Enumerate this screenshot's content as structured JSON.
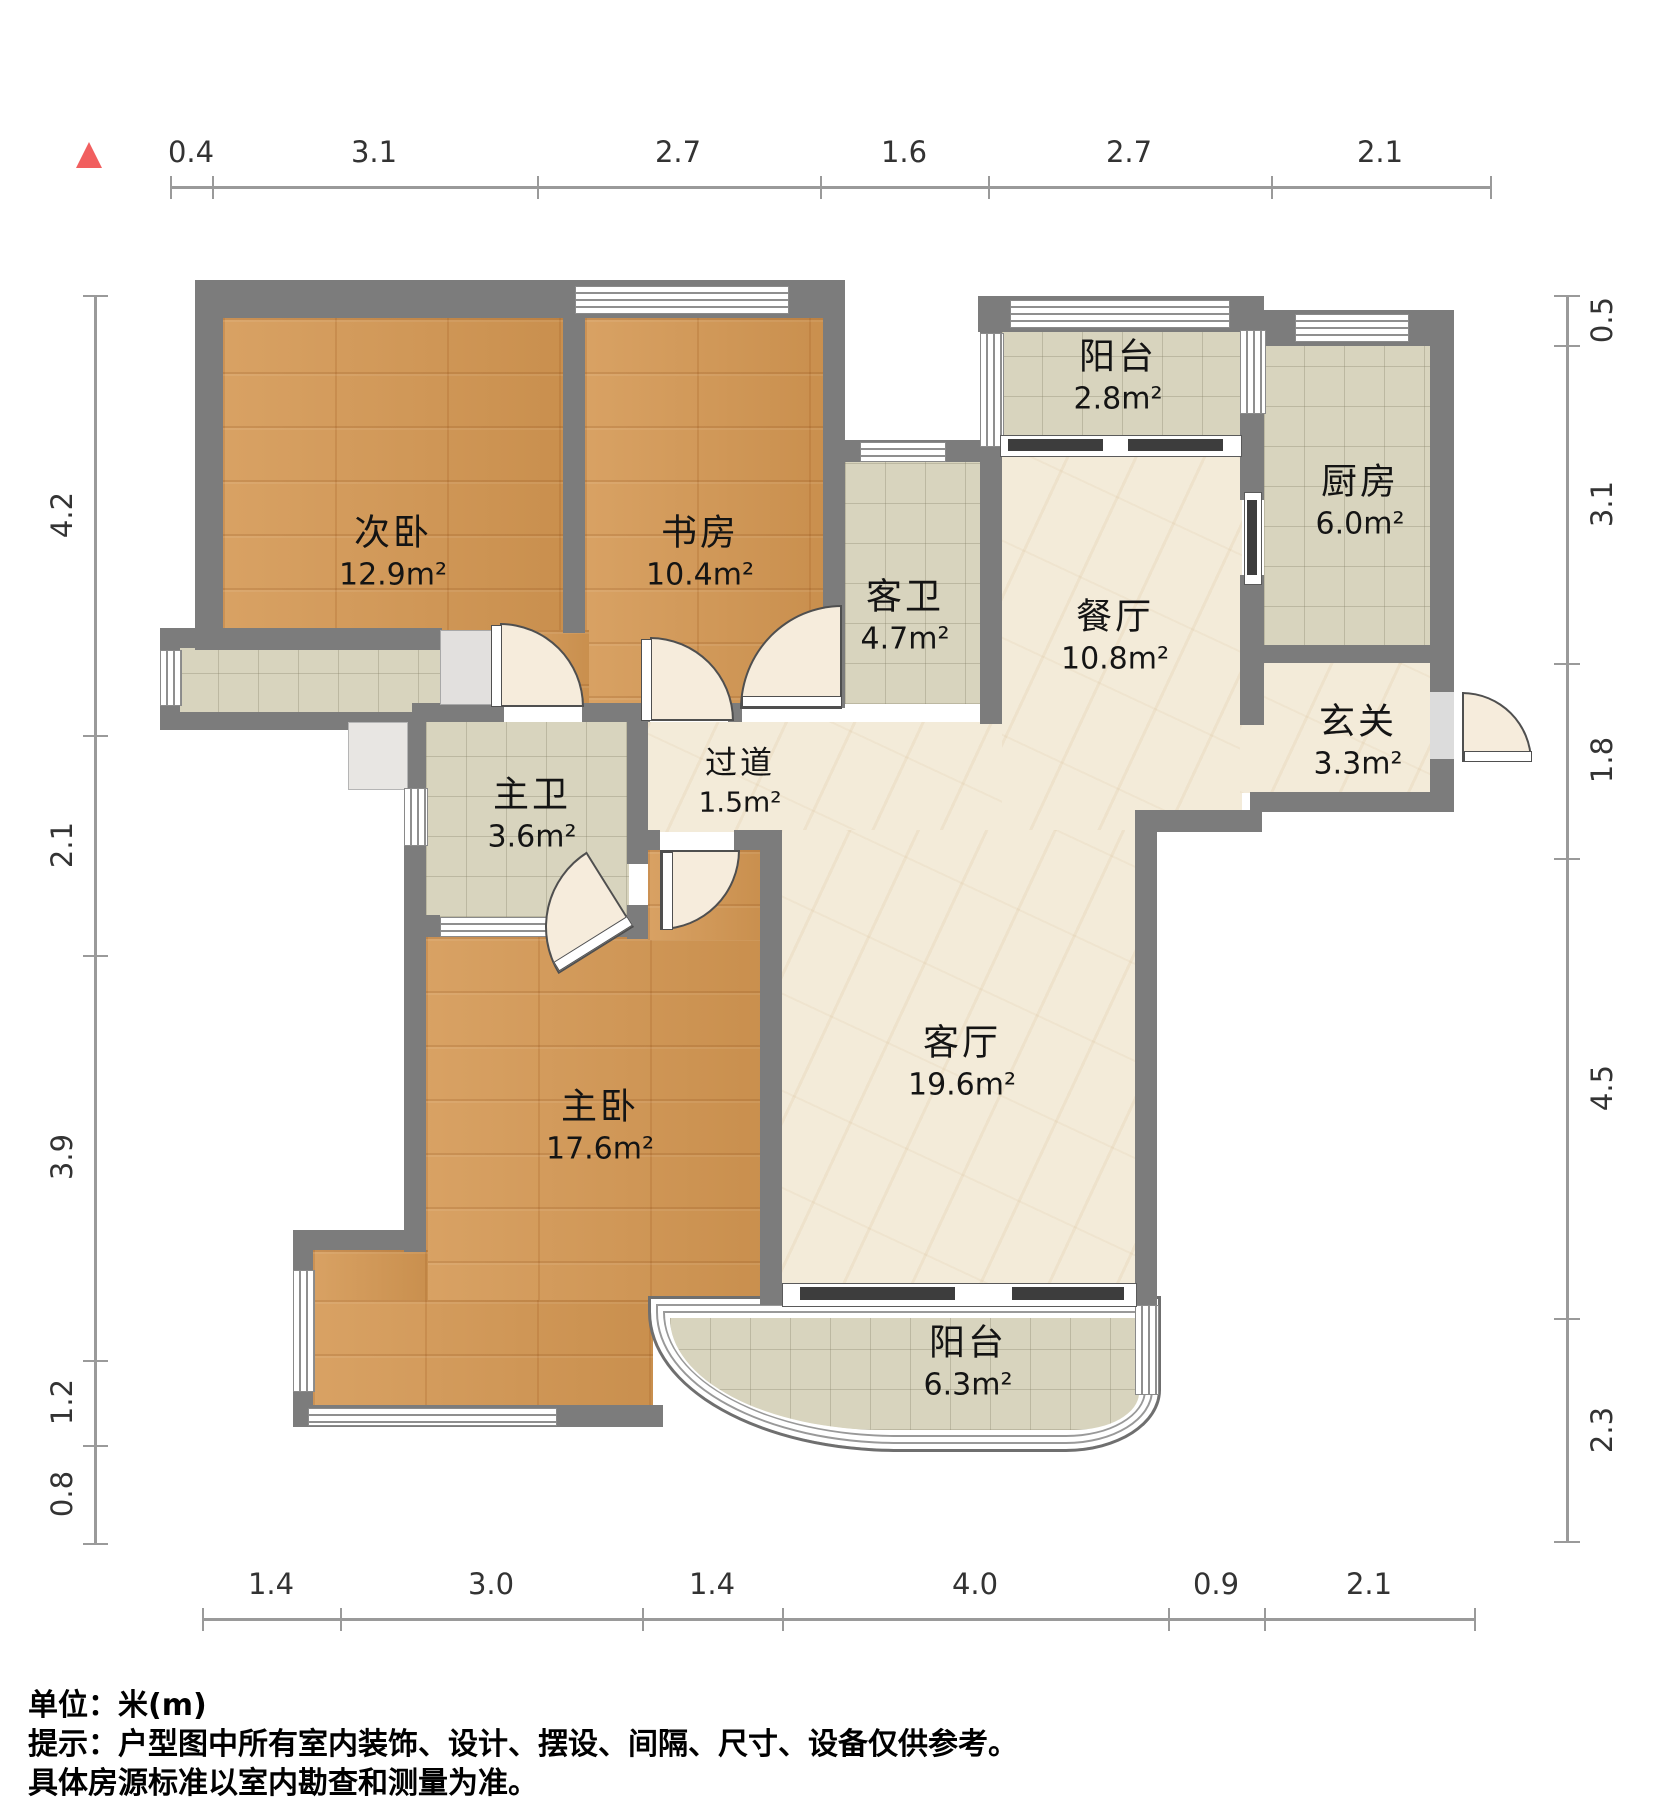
{
  "meta": {
    "unit_note": "单位：米(m)",
    "notice_line1": "提示：户型图中所有室内装饰、设计、摆设、间隔、尺寸、设备仅供参考。",
    "notice_line2": "具体房源标准以室内勘查和测量为准。"
  },
  "north_marker": {
    "color": "#f15f5f",
    "meaning": "north-indicator"
  },
  "rooms": [
    {
      "name": "次卧",
      "area": "12.9m²"
    },
    {
      "name": "书房",
      "area": "10.4m²"
    },
    {
      "name": "客卫",
      "area": "4.7m²"
    },
    {
      "name": "阳台",
      "area": "2.8m²"
    },
    {
      "name": "厨房",
      "area": "6.0m²"
    },
    {
      "name": "餐厅",
      "area": "10.8m²"
    },
    {
      "name": "玄关",
      "area": "3.3m²"
    },
    {
      "name": "主卫",
      "area": "3.6m²"
    },
    {
      "name": "过道",
      "area": "1.5m²"
    },
    {
      "name": "主卧",
      "area": "17.6m²"
    },
    {
      "name": "客厅",
      "area": "19.6m²"
    },
    {
      "name": "阳台",
      "area": "6.3m²"
    }
  ],
  "dims": {
    "top": [
      "0.4",
      "3.1",
      "2.7",
      "1.6",
      "2.7",
      "2.1"
    ],
    "left": [
      "4.2",
      "2.1",
      "3.9",
      "1.2",
      "0.8"
    ],
    "right": [
      "0.5",
      "3.1",
      "1.8",
      "4.5",
      "2.3"
    ],
    "bottom": [
      "1.4",
      "3.0",
      "1.4",
      "4.0",
      "0.9",
      "2.1"
    ]
  },
  "palette": {
    "wall": "#7c7c7c",
    "wood": "#d49752",
    "tile": "#d8d4be",
    "marble": "#f3ebd9"
  }
}
